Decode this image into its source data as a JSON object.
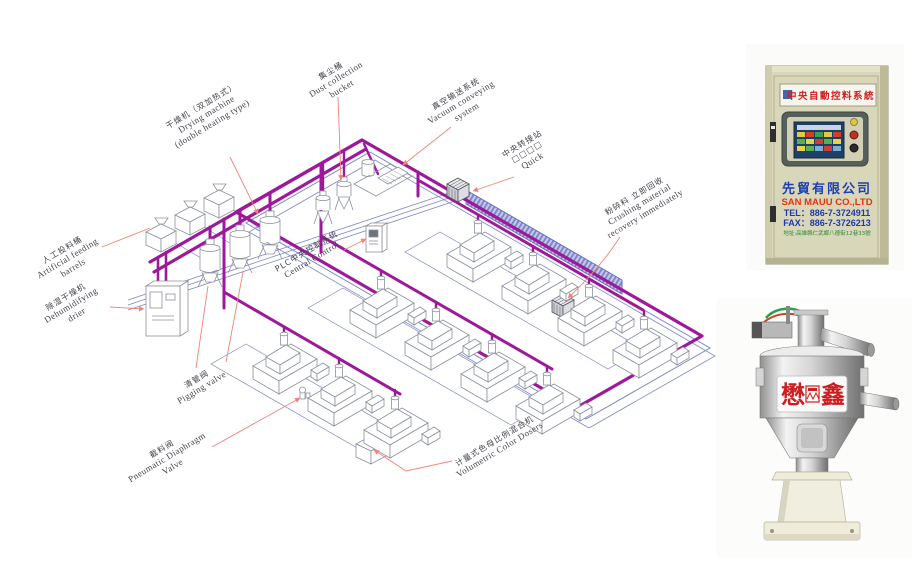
{
  "diagram": {
    "labels": {
      "feeding": {
        "zh": "人工投料桶",
        "en1": "Artificial feeding",
        "en2": "barrels"
      },
      "drying": {
        "zh": "干燥机（双加热式）",
        "en1": "Drying machine",
        "en2": "(double heating type)"
      },
      "dust": {
        "zh": "集尘桶",
        "en1": "Dust collection",
        "en2": "bucket"
      },
      "vacuum": {
        "zh": "真空输送系统",
        "en1": "Vacuum conveying",
        "en2": "system"
      },
      "transfer": {
        "zh": "中央转接站",
        "en1": "□□□□",
        "en2": "Quick"
      },
      "plc": {
        "zh": "PLC中央控制系统",
        "en1": "Central Control",
        "en2": ""
      },
      "dehumid": {
        "zh": "除湿干燥机",
        "en1": "Dehumidifying",
        "en2": "drier"
      },
      "pigging": {
        "zh": "清管阀",
        "en1": "Pigging valve",
        "en2": ""
      },
      "crushing": {
        "zh": "粉碎料 立即回收",
        "en1": "Crushing material",
        "en2": "recovery immediately"
      },
      "diaphragm": {
        "zh": "截料阀",
        "en1": "Pneumatic Diaphragm",
        "en2": "Valve"
      },
      "dosers": {
        "zh": "计量式色母比例混合机",
        "en1": "Volumetric Color Dosers",
        "en2": ""
      }
    },
    "colors": {
      "pipe_main": "#9e189a",
      "pipe_secondary": "#8087c8",
      "leader_line": "#f08478",
      "machine_outline": "#8c929c"
    }
  },
  "control_cabinet_photo": {
    "banner": "中央自動控料系統",
    "company_zh": "先貿有限公司",
    "company_en": "SAN MAUU CO.,LTD",
    "tel": "TEL：886-7-3724911",
    "fax": "FAX：886-7-3726213",
    "address": "地址:高雄縣仁武鄉八德街12巷33號"
  },
  "hopper_photo": {
    "logo_left": "懋",
    "logo_right": "鑫"
  }
}
